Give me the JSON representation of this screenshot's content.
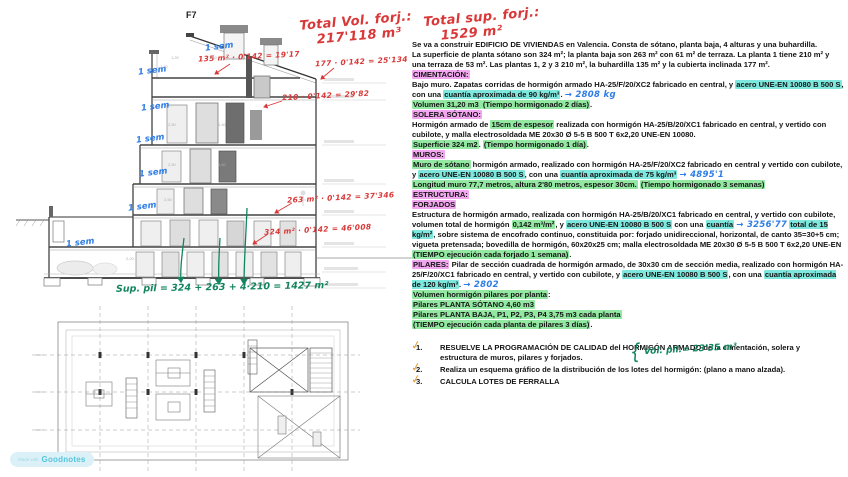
{
  "colors": {
    "highlight_pink": "#f2a6ef",
    "highlight_cyan": "#7fe8de",
    "highlight_green": "#93e9a2",
    "handwriting_red": "#d93838",
    "handwriting_blue": "#2e7de5",
    "handwriting_green": "#12855f",
    "check_orange": "#e89a2e"
  },
  "drawing": {
    "f7_label": "F7",
    "red_total_vol_line1": "Total Vol. forj.:",
    "red_total_vol_line2": "217'118 m³",
    "red_calcs": {
      "c1": "135 m² · 0'142 = 19'17",
      "c2": "177 · 0'142 = 25'134",
      "c3": "210 · 0'142 = 29'82",
      "c4": "263 m² · 0'142 = 37'346",
      "c5": "324 m² · 0'142 = 46'008"
    },
    "week_label": "1 sem",
    "green_sum": "Sup. pil = 324 + 263 + 4·210 = 1427 m²",
    "dims": [
      "1,20",
      "1,40",
      "1,30",
      "2,50",
      "1,40",
      "2,50",
      "1,40",
      "2,50",
      "2,20"
    ],
    "watermark_prefix": "Made with",
    "watermark_brand": "Goodnotes"
  },
  "notes": {
    "red_total_sup_line1": "Total sup. forj.:",
    "red_total_sup_line2": "1529 m²",
    "vol_pil_brace": "{",
    "vol_pil_text": "Vol. pil.= 23'35 m³",
    "paragraphs": [
      {
        "segments": [
          {
            "t": "Se va a construir EDIFICIO DE VIVIENDAS en Valencia. Consta de sótano, planta baja, 4 alturas y una buhardilla."
          }
        ]
      },
      {
        "segments": [
          {
            "t": "La superficie de planta sótano son 324 m²; la planta baja son 263 m² con 61 m² de terraza. La planta 1 tiene 210 m² y una terraza de 53 m². Las plantas 1, 2 y 3 210 m², la buhardilla 135 m² y la cubierta inclinada 177 m²."
          }
        ]
      },
      {
        "segments": [
          {
            "t": "CIMENTACIÓN:",
            "h": "pink"
          }
        ]
      },
      {
        "segments": [
          {
            "t": "Bajo muro. Zapatas corridas de hormigón armado HA-25/F/20/XC2 fabricado en central, y "
          },
          {
            "t": "acero UNE-EN 10080 B 500 S",
            "h": "cyan"
          },
          {
            "t": ", con una "
          },
          {
            "t": "cuantía aproximada de 90 kg/m³",
            "h": "cyan"
          },
          {
            "t": ". "
          },
          {
            "t": "→ 2808 kg",
            "hw": "blue"
          }
        ]
      },
      {
        "segments": [
          {
            "t": "Volumen 31,20 m3 ",
            "h": "green"
          },
          {
            "t": "(Tiempo hormigonado 2 días)",
            "h": "green"
          },
          {
            "t": "."
          }
        ]
      },
      {
        "segments": [
          {
            "t": "SOLERA SÓTANO:",
            "h": "pink"
          }
        ]
      },
      {
        "segments": [
          {
            "t": "Hormigón armado de "
          },
          {
            "t": "15cm de espesor",
            "h": "green"
          },
          {
            "t": " realizada con hormigón HA-25/B/20/XC1 fabricado en central, y vertido con cubilote, y malla electrosoldada ME 20x30 Ø 5-5 B 500 T 6x2,20 UNE-EN 10080."
          }
        ]
      },
      {
        "segments": [
          {
            "t": "Superficie 324 m2",
            "h": "green"
          },
          {
            "t": ". "
          },
          {
            "t": "(Tiempo hormigonado 1 día)",
            "h": "green"
          },
          {
            "t": "."
          }
        ]
      },
      {
        "segments": [
          {
            "t": "MUROS:",
            "h": "pink"
          }
        ]
      },
      {
        "segments": [
          {
            "t": "Muro de sótano",
            "h": "green"
          },
          {
            "t": " hormigón armado, realizado con hormigón HA-25/F/20/XC2 fabricado en central y vertido con cubilote, y "
          },
          {
            "t": "acero UNE-EN 10080 B 500 S",
            "h": "cyan"
          },
          {
            "t": ", con una "
          },
          {
            "t": "cuantía aproximada de 75 kg/m³",
            "h": "cyan"
          },
          {
            "t": " "
          },
          {
            "t": "→ 4895'1",
            "hw": "blue"
          }
        ]
      },
      {
        "segments": [
          {
            "t": "Longitud muro 77,7 metros, altura 2'80 metros, espesor 30cm.",
            "h": "green"
          },
          {
            "t": " "
          },
          {
            "t": "(Tiempo hormigonado 3 semanas)",
            "h": "green"
          }
        ]
      },
      {
        "segments": [
          {
            "t": "ESTRUCTURA:",
            "h": "pink"
          }
        ]
      },
      {
        "segments": [
          {
            "t": "FORJADOS",
            "h": "pink"
          }
        ]
      },
      {
        "segments": [
          {
            "t": "Estructura de hormigón armado, realizada con hormigón HA-25/B/20/XC1 fabricado en central, y vertido con cubilote, volumen total de hormigón "
          },
          {
            "t": "0,142 m³/m²",
            "h": "green"
          },
          {
            "t": ", y "
          },
          {
            "t": "acero UNE-EN 10080 B 500 S",
            "h": "cyan"
          },
          {
            "t": " con una "
          },
          {
            "t": "cuantía",
            "h": "cyan"
          },
          {
            "t": " "
          },
          {
            "t": "→ 3256'77",
            "hw": "blue"
          },
          {
            "t": " "
          },
          {
            "t": "total de 15 kg/m²",
            "h": "cyan"
          },
          {
            "t": ", sobre sistema de encofrado continuo, constituida por: forjado unidireccional, horizontal, de canto 35=30+5 cm; vigueta pretensada; bovedilla de hormigón, 60x20x25 cm; malla electrosoldada ME 20x30 Ø 5-5 B 500 T 6x2,20 UNE-EN"
          }
        ]
      },
      {
        "segments": [
          {
            "t": "(TIEMPO ejecución cada forjado 1 semana)",
            "h": "green"
          },
          {
            "t": "."
          }
        ]
      },
      {
        "segments": [
          {
            "t": "PILARES:",
            "h": "pink"
          },
          {
            "t": " Pilar de sección cuadrada de hormigón armado, de 30x30 cm de sección media, realizado con hormigón HA-25/F/20/XC1 fabricado en central, y vertido con cubilote, y "
          },
          {
            "t": "acero UNE-EN 10080 B 500 S",
            "h": "cyan"
          },
          {
            "t": ", con una "
          },
          {
            "t": "cuantía aproximada de 120 kg/m³",
            "h": "cyan"
          },
          {
            "t": ". "
          },
          {
            "t": "→ 2802",
            "hw": "blue"
          }
        ]
      },
      {
        "segments": [
          {
            "t": "Volumen hormigón pilares por planta",
            "h": "green"
          },
          {
            "t": ":"
          }
        ]
      },
      {
        "segments": [
          {
            "t": "Pilares PLANTA SÓTANO 4,60 m3",
            "h": "green"
          }
        ]
      },
      {
        "segments": [
          {
            "t": "Pilares PLANTA BAJA, P1, P2, P3, P4  3,75 m3 cada planta",
            "h": "green"
          }
        ]
      },
      {
        "segments": [
          {
            "t": "(TIEMPO ejecución cada planta de pilares 3 días)",
            "h": "green"
          },
          {
            "t": "."
          }
        ]
      }
    ],
    "tasks": [
      {
        "num": "1.",
        "text": "RESUELVE LA PROGRAMACIÓN  DE CALIDAD del HORMIGÓN ARMADO de la cimentación, solera y estructura de muros, pilares y forjados.",
        "checked": true
      },
      {
        "num": "2.",
        "text": "Realiza un esquema gráfico de la distribución de los lotes del hormigón: (plano a mano alzada).",
        "checked": true
      },
      {
        "num": "3.",
        "text": "CALCULA LOTES DE FERRALLA",
        "checked": true
      }
    ]
  }
}
